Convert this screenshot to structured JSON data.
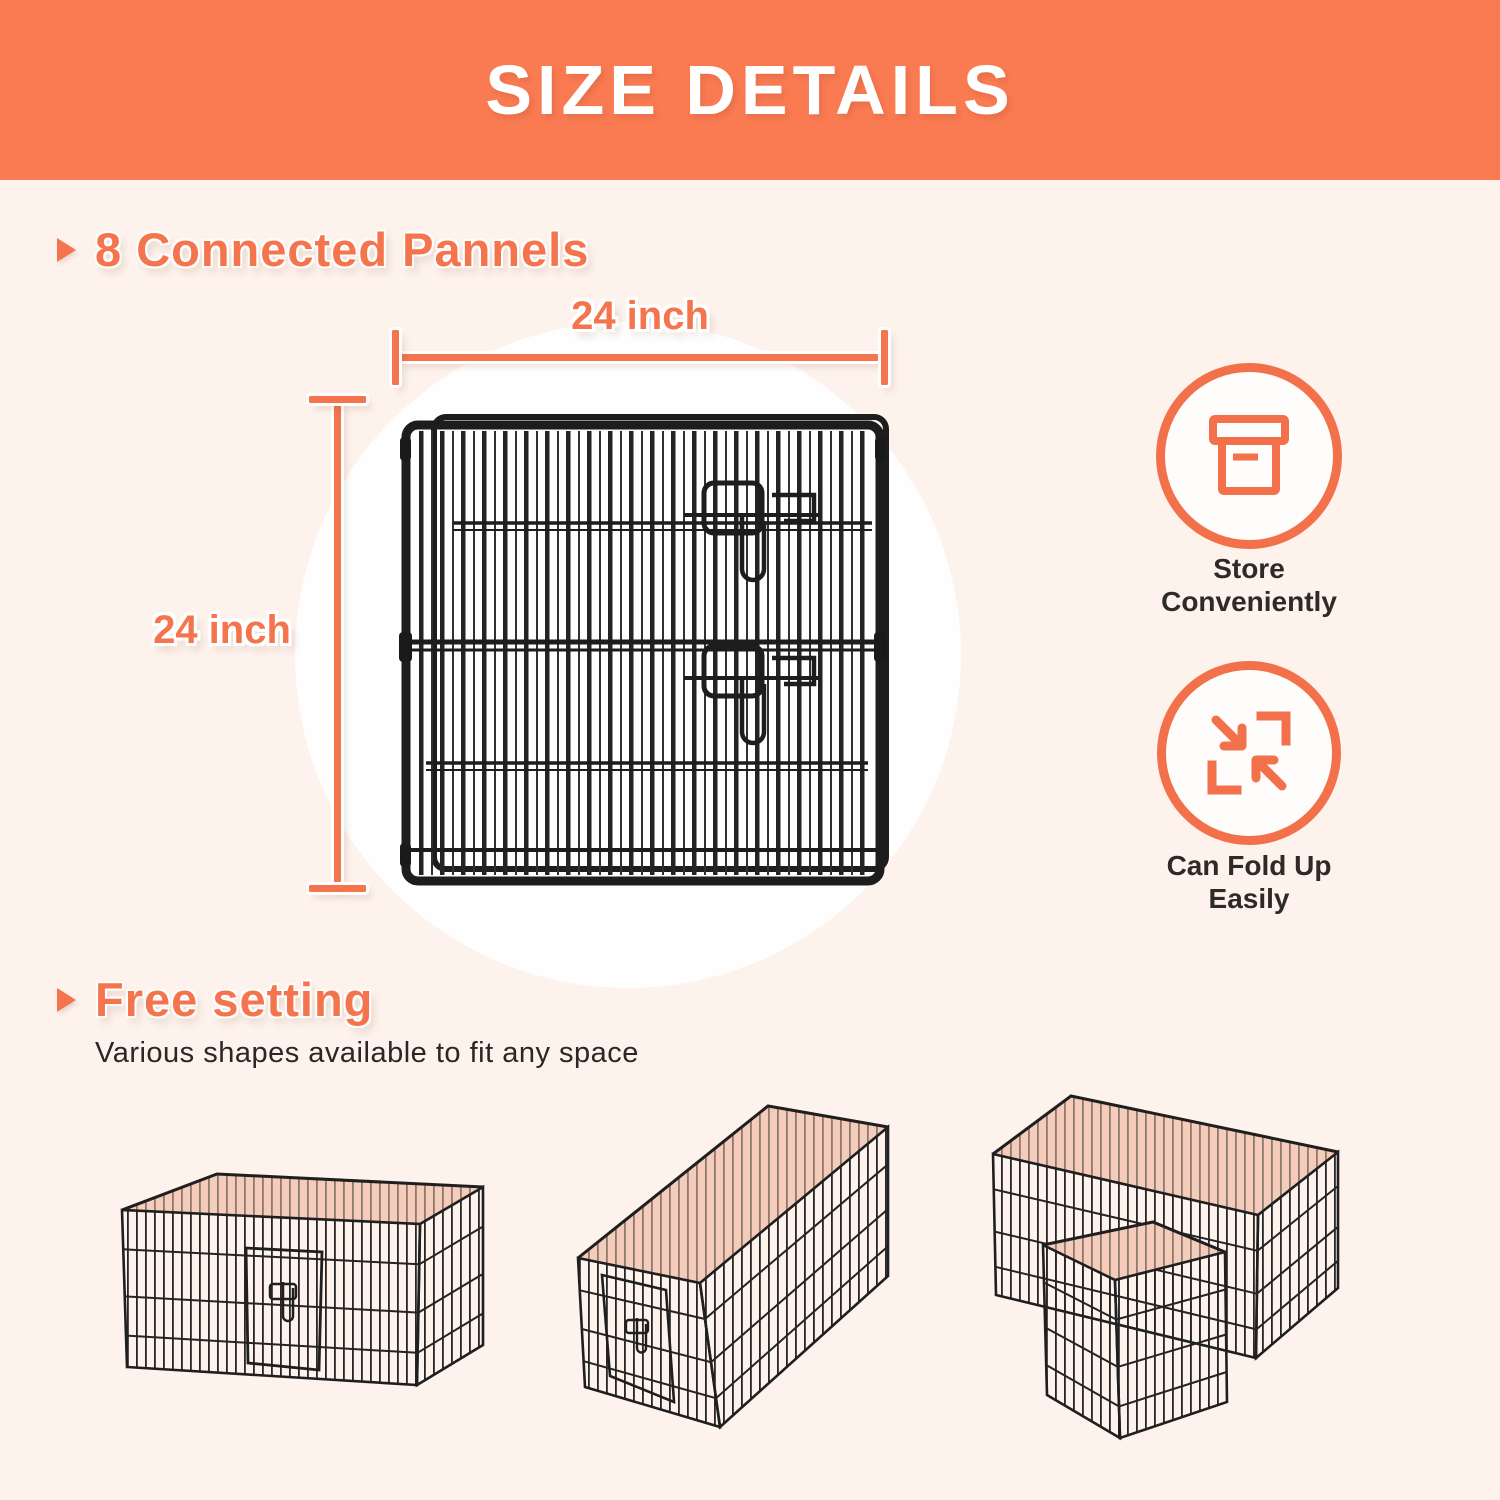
{
  "header": {
    "title": "SIZE DETAILS"
  },
  "colors": {
    "banner_orange": "#FA7A51",
    "accent_orange": "#F4744E",
    "background_pink": "#FDF2EC",
    "dark_text": "#2E2A27",
    "pen_floor_salmon": "#F5CBB9",
    "wire_black": "#232323",
    "white": "#FFFFFF"
  },
  "section_panels": {
    "heading": "8 Connected Pannels",
    "width_label": "24 inch",
    "height_label": "24 inch",
    "panel_image": "black-wire-panel-photo",
    "features": [
      {
        "icon": "storage-box-icon",
        "line1": "Store",
        "line2": "Conveniently"
      },
      {
        "icon": "fold-arrows-icon",
        "line1": "Can Fold Up",
        "line2": "Easily"
      }
    ]
  },
  "section_free_setting": {
    "heading": "Free setting",
    "subtext": "Various shapes available to fit any space",
    "configurations": [
      {
        "image": "square-pen-photo"
      },
      {
        "image": "long-rectangle-pen-photo"
      },
      {
        "image": "l-shape-pen-photo"
      }
    ]
  }
}
